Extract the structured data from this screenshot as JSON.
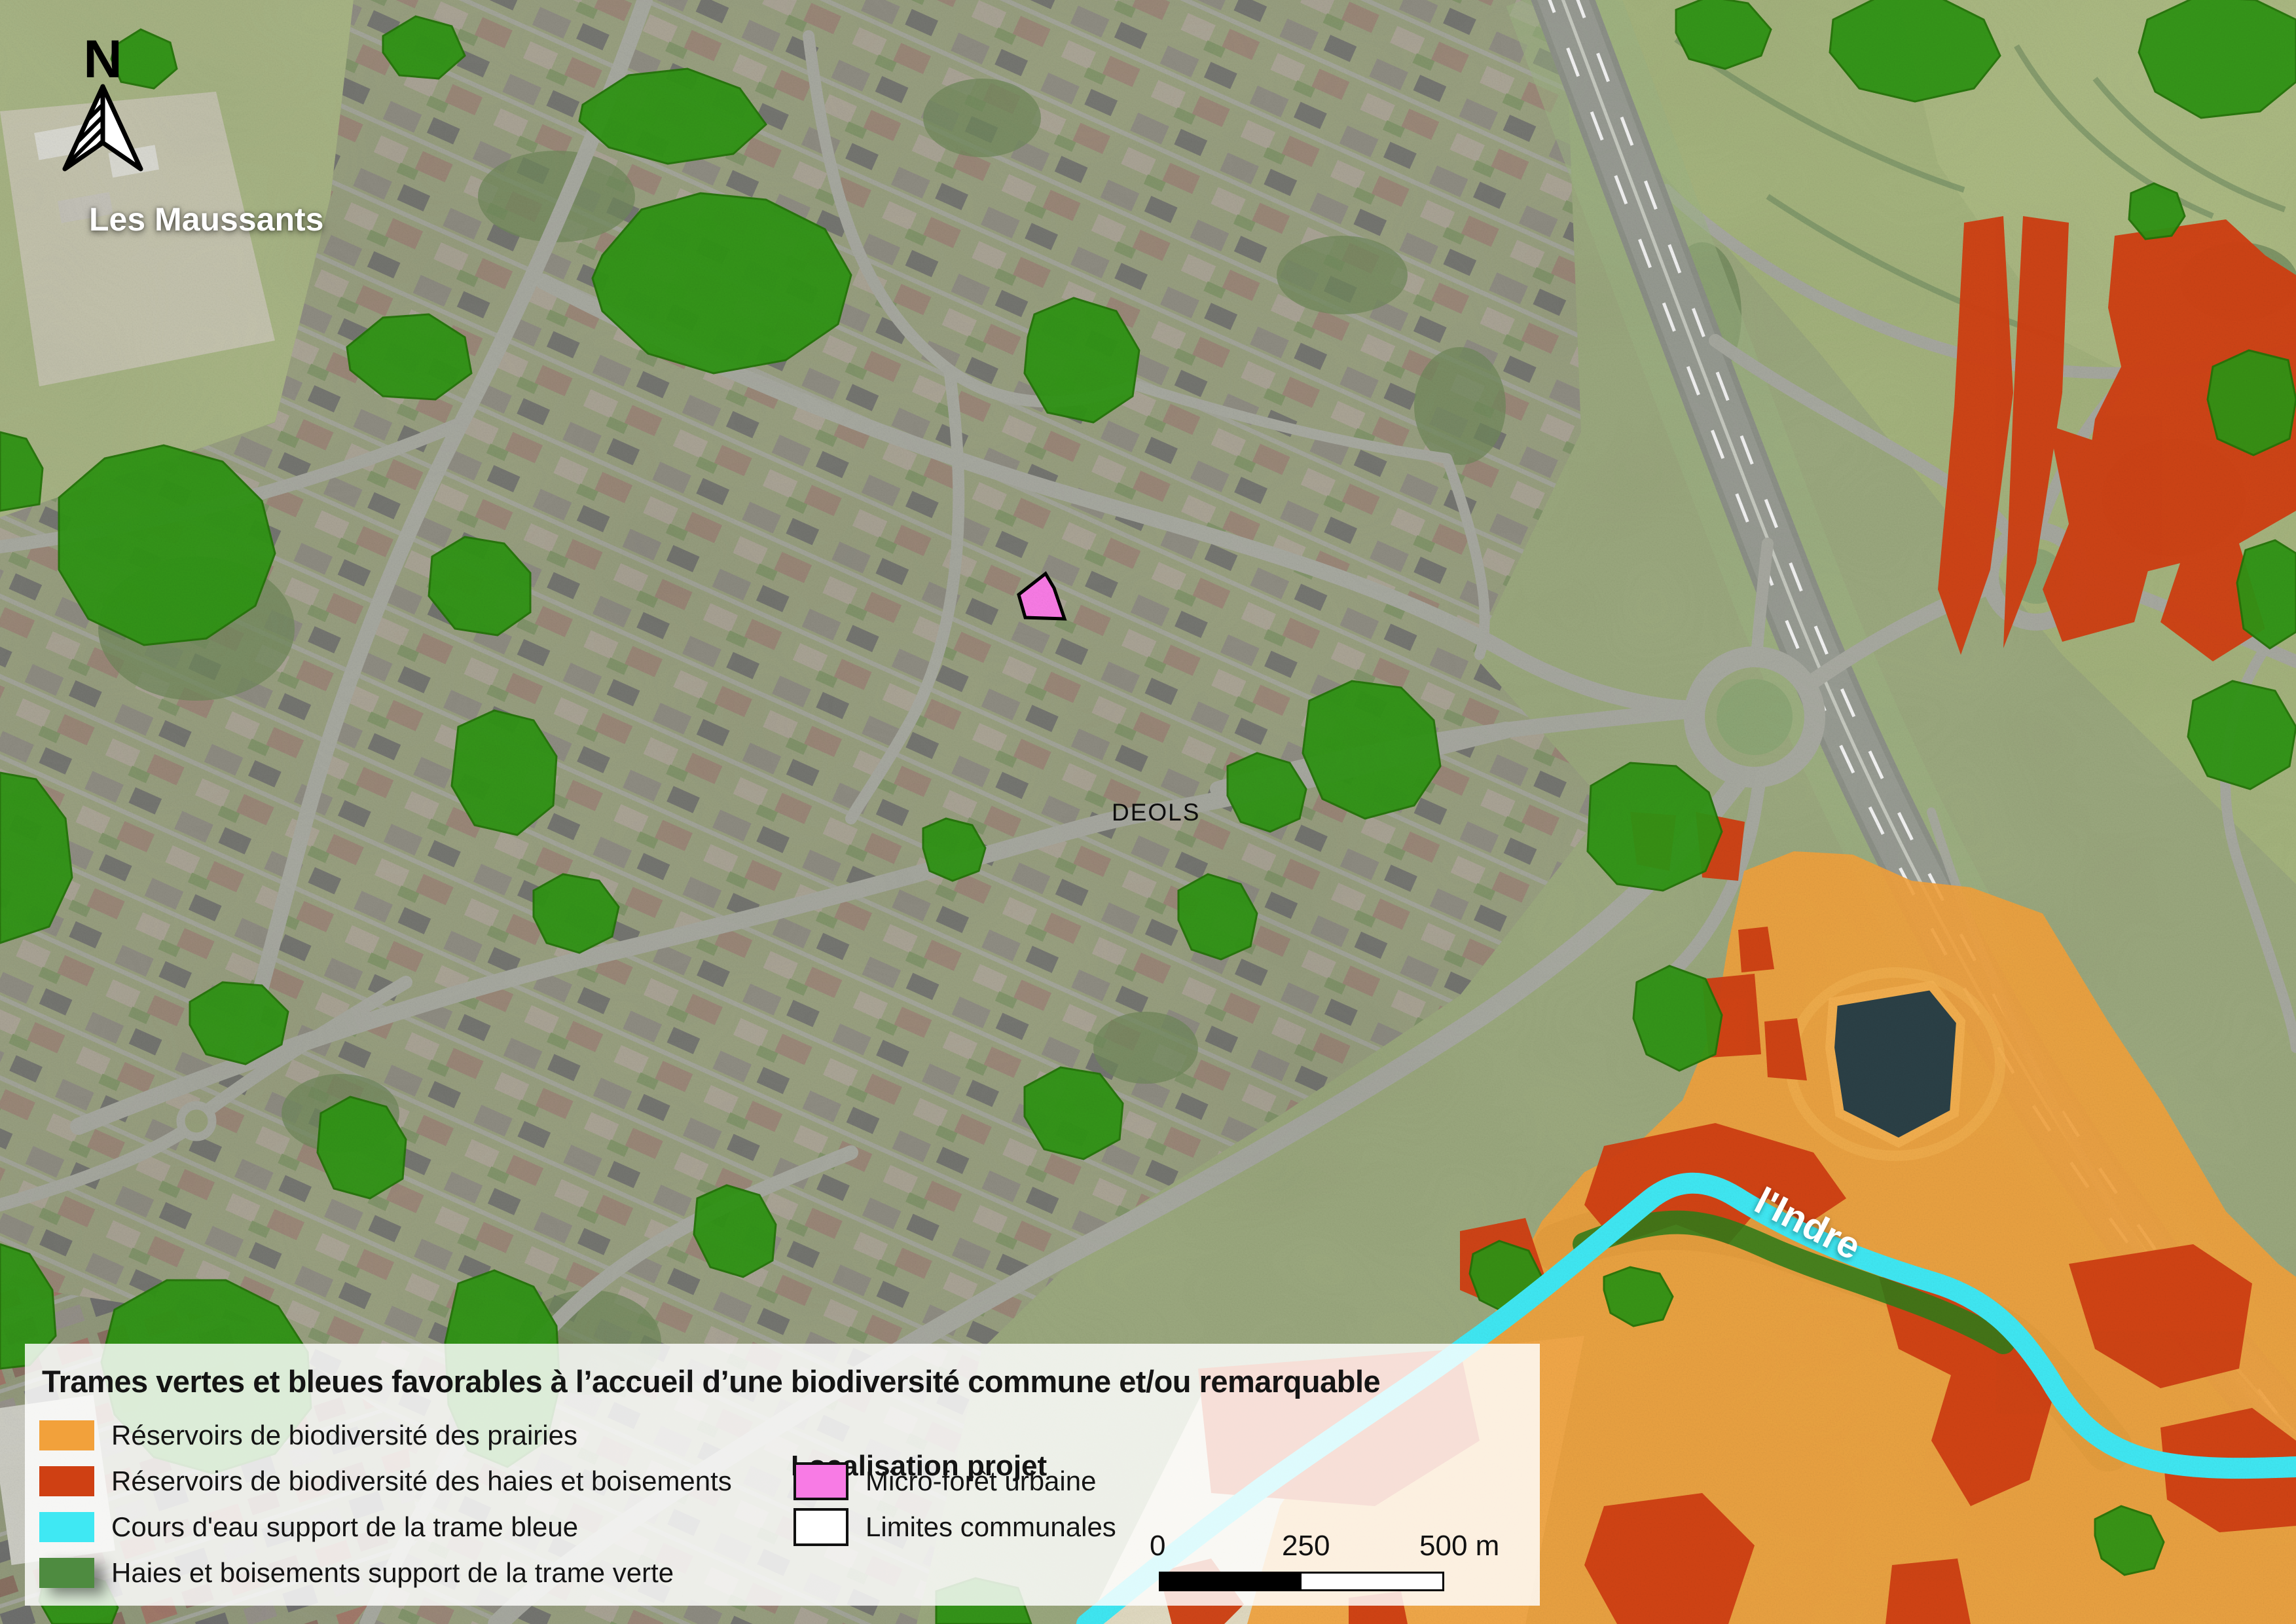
{
  "map": {
    "labels": {
      "region": "Les Maussants",
      "commune": "DEOLS",
      "river": "l'Indre",
      "north": "N"
    }
  },
  "legend": {
    "title": "Trames vertes et bleues favorables à l’accueil d’une biodiversité commune et/ou remarquable",
    "items": [
      {
        "key": "prairie",
        "label": "Réservoirs de biodiversité des prairies"
      },
      {
        "key": "haies",
        "label": "Réservoirs de biodiversité des haies et boisements"
      },
      {
        "key": "eau",
        "label": "Cours d'eau support de la trame bleue"
      },
      {
        "key": "verte",
        "label": "Haies et boisements support de la trame verte"
      }
    ],
    "project": {
      "header": "Localisation projet",
      "items": [
        {
          "key": "projet",
          "label": "Micro-forêt urbaine"
        },
        {
          "key": "limites",
          "label": "Limites communales"
        }
      ]
    },
    "scale": {
      "ticks": [
        "0",
        "250",
        "500 m"
      ]
    }
  },
  "colors": {
    "prairie": "#F2A13B",
    "haies": "#CF4013",
    "eau": "#3FE8F3",
    "verte": "#4E8B40",
    "verte-map": "#2F9414",
    "projet": "#F87BE5",
    "limites": "#FFFFFF",
    "basin": "#2B4046",
    "road": "#A9ABA2",
    "highway": "#8E9289"
  }
}
